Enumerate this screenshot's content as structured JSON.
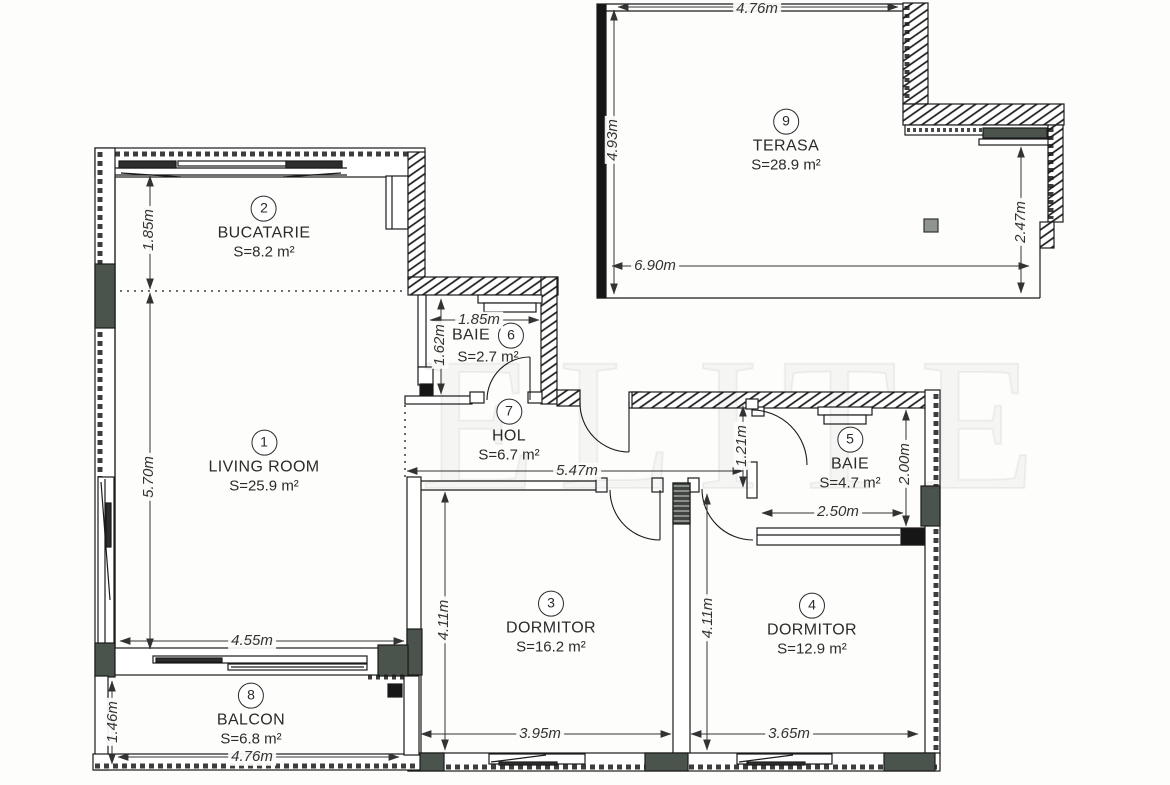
{
  "watermark": "ELITE",
  "rooms": [
    {
      "num": "1",
      "name": "LIVING ROOM",
      "area": "S=25.9 m²"
    },
    {
      "num": "2",
      "name": "BUCATARIE",
      "area": "S=8.2 m²"
    },
    {
      "num": "3",
      "name": "DORMITOR",
      "area": "S=16.2 m²"
    },
    {
      "num": "4",
      "name": "DORMITOR",
      "area": "S=12.9 m²"
    },
    {
      "num": "5",
      "name": "BAIE",
      "area": "S=4.7 m²"
    },
    {
      "num": "6",
      "name": "BAIE",
      "area": "S=2.7 m²"
    },
    {
      "num": "7",
      "name": "HOL",
      "area": "S=6.7 m²"
    },
    {
      "num": "8",
      "name": "BALCON",
      "area": "S=6.8 m²"
    },
    {
      "num": "9",
      "name": "TERASA",
      "area": "S=28.9 m²"
    }
  ],
  "dims": {
    "terasa_top": "4.76m",
    "terasa_left": "4.93m",
    "terasa_bottom": "6.90m",
    "terasa_right": "2.47m",
    "kitchen_depth": "1.85m",
    "living_height": "5.70m",
    "living_width": "4.55m",
    "baie6_width": "1.85m",
    "baie6_height": "1.62m",
    "hol_width": "5.47m",
    "baie5_offset": "1.21m",
    "baie5_height": "2.00m",
    "baie5_width": "2.50m",
    "dorm3_height": "4.11m",
    "dorm3_width": "3.95m",
    "dorm4_height": "4.11m",
    "dorm4_width": "3.65m",
    "balcon_height": "1.46m",
    "balcon_width": "4.76m"
  }
}
